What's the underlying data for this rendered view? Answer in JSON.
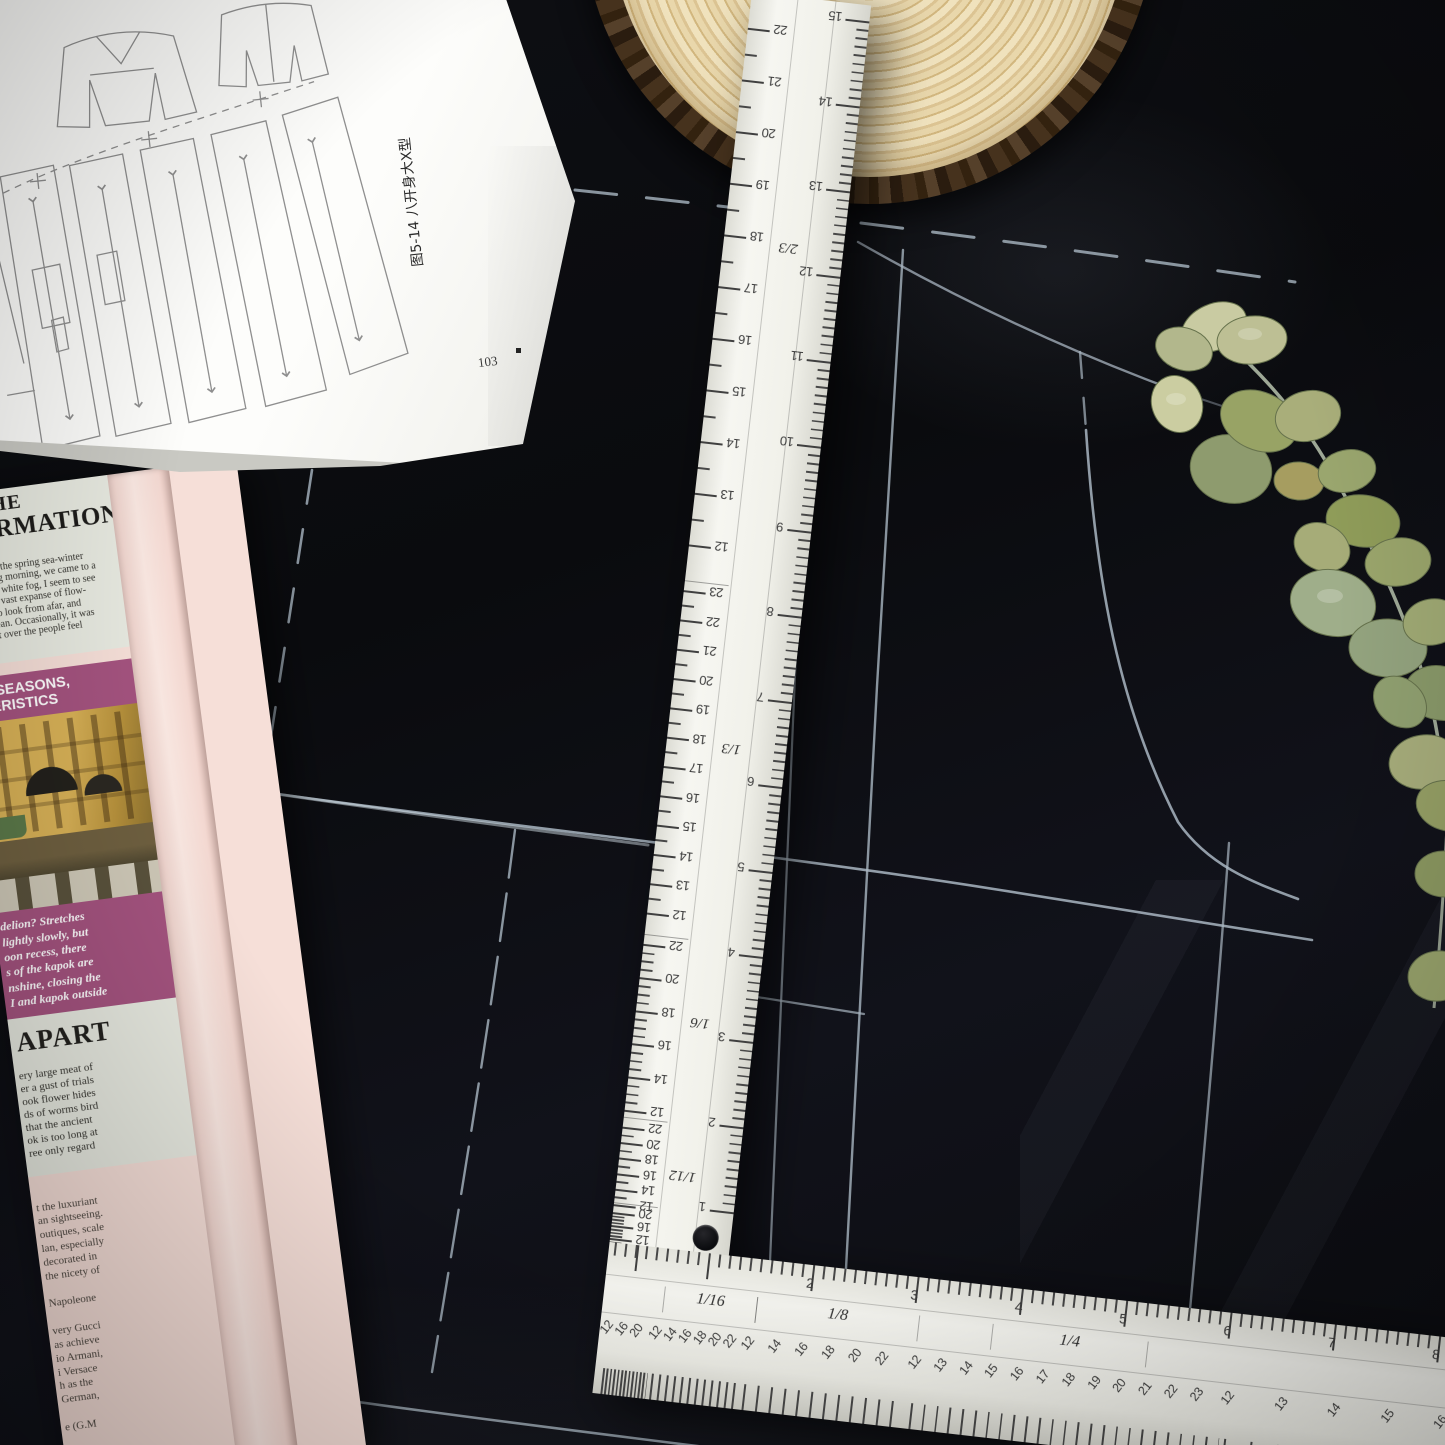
{
  "book": {
    "caption": "图5-14 八开身大X型",
    "page_number": "103"
  },
  "newspaper": {
    "headline1_line1": "G THE",
    "headline1_line2": "FFIRMATION",
    "body1_lines": [
      "unity, I saw the spring sea-winter",
      "was a spring morning, we came to a",
      "n the misty white fog, I seem to see",
      "stars, go, a vast expanse of flow-",
      "the eyes, to look from afar, and",
      "mense ocean. Occasionally, it was",
      "louds drift over the people feel",
      "cean."
    ],
    "banner1_lines": [
      "UR SEASONS,",
      "CTERISTICS"
    ],
    "banner2_lines": [
      "delion? Stretches",
      "lightly slowly, but",
      "oon recess, there",
      "s of the kapok are",
      "nshine, closing the",
      "I and kapok outside"
    ],
    "headline2": "APART",
    "body2_lines": [
      "ery large meat of",
      "er a gust of trials",
      "ook flower hides",
      "ds of worms bird",
      "that the ancient",
      "ok is too long at",
      "ree only regard"
    ],
    "body3_lines": [
      "t the luxuriant",
      "an sightseeing.",
      "outiques, scale",
      "lan, especially",
      "decorated in",
      "the nicety of",
      "",
      "Napoleone",
      "",
      "very Gucci",
      "as achieve",
      "io Armani,",
      "i Versace",
      "h as the",
      "German,",
      "",
      "e (G.M",
      "",
      "prices"
    ]
  },
  "ruler": {
    "vertical": {
      "left_scales": [
        {
          "label": "2/3",
          "numbers": [
            22,
            21,
            20,
            19,
            18,
            17,
            16,
            15,
            14,
            13,
            12
          ],
          "start": 36,
          "step": 52,
          "tick": 26
        },
        {
          "label": "1/3",
          "numbers": [
            23,
            22,
            21,
            20,
            19,
            18,
            17,
            16,
            15,
            14,
            13,
            12
          ],
          "start": 602,
          "step": 29.5,
          "tick": 14.75
        },
        {
          "label": "1/6",
          "numbers": [
            22,
            20,
            18,
            16,
            14,
            12
          ],
          "start": 958,
          "step": 33.4,
          "tick": 8.35
        },
        {
          "label": "1/12",
          "numbers": [
            22,
            20,
            18,
            16,
            14,
            12
          ],
          "start": 1142,
          "step": 15.6,
          "tick": 7.8
        },
        {
          "label": "",
          "numbers": [
            20,
            16,
            12
          ],
          "start": 1228,
          "step": 13,
          "tick": 3.3
        }
      ],
      "mid_labels": [
        {
          "text": "2/3",
          "y": 252
        },
        {
          "text": "1/3",
          "y": 756
        },
        {
          "text": "1/6",
          "y": 1032
        },
        {
          "text": "1/12",
          "y": 1186
        }
      ],
      "right_scale": {
        "numbers": [
          15,
          14,
          13,
          12,
          11,
          10,
          9,
          8,
          7,
          6,
          5,
          4,
          3,
          2,
          1
        ],
        "start": 16,
        "step": 85.6,
        "tick": 8.56
      }
    },
    "horizontal": {
      "top_scale": {
        "numbers": [
          2,
          3,
          4,
          5,
          6,
          7,
          8
        ],
        "start": 205,
        "step": 105,
        "tick": 10.5
      },
      "band_labels": [
        {
          "text": "1/16",
          "x": 60,
          "w": 92
        },
        {
          "text": "1/8",
          "x": 153,
          "w": 162
        },
        {
          "text": "1/4",
          "x": 390,
          "w": 155
        }
      ],
      "bottom_groups": [
        {
          "numbers": [
            12,
            16,
            20
          ],
          "start": 8,
          "step": 15,
          "tick": 3.7
        },
        {
          "numbers": [
            12,
            14,
            16,
            18,
            20,
            22
          ],
          "start": 57,
          "step": 15,
          "tick": 7.5
        },
        {
          "numbers": [
            12,
            14,
            16,
            18,
            20,
            22
          ],
          "start": 150,
          "step": 27,
          "tick": 13.5
        },
        {
          "numbers": [
            12,
            13,
            14,
            15,
            16,
            17,
            18,
            19,
            20,
            21,
            22,
            23
          ],
          "start": 318,
          "step": 25.8,
          "tick": 12.9
        },
        {
          "numbers": [
            12,
            13,
            14,
            15,
            16
          ],
          "start": 633,
          "step": 53.5,
          "tick": 26.7
        }
      ]
    }
  },
  "colors": {
    "fabric": "#0b0c10",
    "chalk": "#a9b6c2",
    "ruler_body": "#f2f2ec",
    "newspaper_pink": "#f6dfd8",
    "banner_magenta": "#a4537f",
    "newsprint_bg": "#e7e9e0",
    "wood_light": "#eedfb9",
    "wood_bark": "#38281a",
    "leaf_green": "#9aa56d",
    "book_paper": "#fafaf7"
  }
}
